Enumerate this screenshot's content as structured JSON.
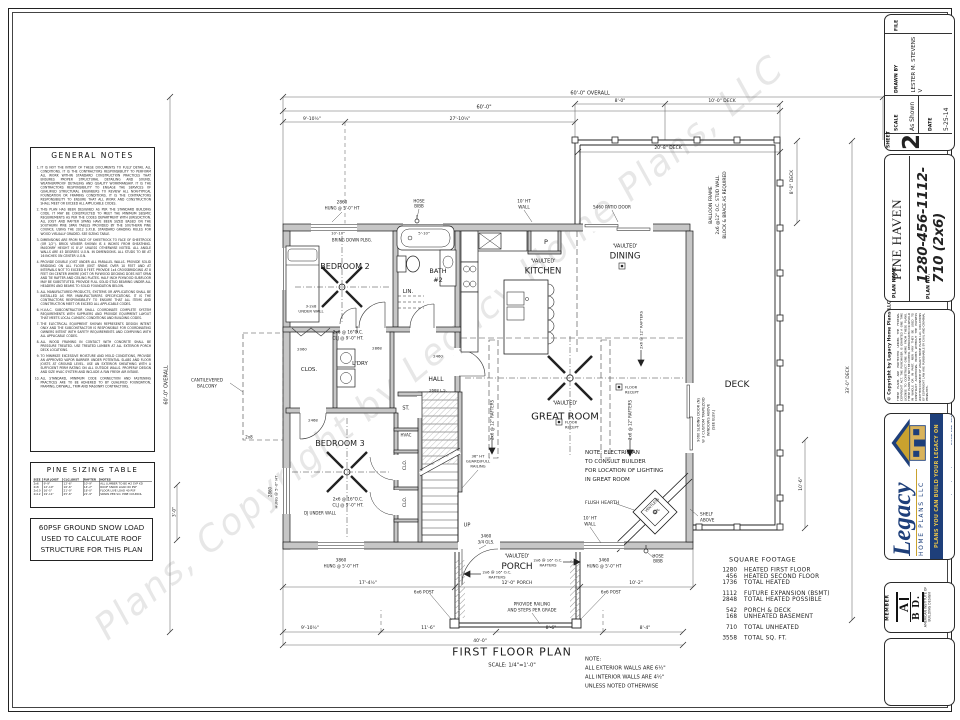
{
  "sheet": {
    "watermark": "Plans, Copyright by Legacy Home Plans, LLC",
    "general_notes": {
      "title": "GENERAL NOTES",
      "notes": [
        "IT IS NOT THE INTENT OF THESE DOCUMENTS TO FULLY DETAIL ALL CONDITIONS. IT IS THE CONTRACTORS RESPONSIBILITY TO PERFORM ALL WORK WITHIN STANDARD CONSTRUCTION PRACTICES THAT ENSURES PROPER STRUCTURAL DETAILING AND SOUND, WEATHERPROOF DETAILING AND QUALITY WORKMANSHIP. IT IS THE CONTRACTORS RESPONSIBILITY TO ENGAGE THE SERVICES OF QUALIFIED STRUCTURAL ENGINEERS TO REVIEW ALL NON-TYPICAL FOUNDATION OR FRAMING CONDITIONS. IT IS THE CONTRACTORS RESPONSIBILITY TO ENSURE THAT ALL WORK AND CONSTRUCTION SHALL MEET OR EXCEED ALL APPLICABLE CODES.",
        "THIS PLAN HAS BEEN DESIGNED AS PER THE STANDARD BUILDING CODE. IT MAY BE CONSTRUCTED TO MEET THE MINIMUM SEISMIC REQUIREMENTS AS PER THE CODES DEPARTMENT WITH JURISDICTION. ALL JOIST AND RAFTER SPANS HAVE BEEN SIZED BASED ON THE SOUTHERN PINE SPAN TABLES PROVIDED BY THE SOUTHERN PINE COUNCIL USING THE 2012 S.P.I.B. STANDARD GRADING RULES FOR WOOD VISUALLY GRADED. SEE SIZING TABLE.",
        "DIMENSIONS ARE FROM FACE OF SHEETROCK TO FACE OF SHEETROCK (OR 1/2\"). BRICK VENEER SHOWN IS 4 INCHES FROM SHEATHING. MASONRY HEIGHT IS 8'-0\" UNLESS OTHERWISE NOTED. ALL ANGLE WALLS ARE 45 DEGREES U.O.N. IN DIMENSIONS. ALL STUDS TO BE AT 16 INCHES ON CENTER U.O.N.",
        "PROVIDE DOUBLE JOIST UNDER ALL PARALLEL WALLS. PROVIDE SOLID BRIDGING ON ALL FLOOR JOIST SPANS OVER 10 FEET AND AT INTERVALS NOT TO EXCEED 8 FEET. PROVIDE 1x4 CROSSBRIDGING AT 8 FEET ON CENTER WHERE JOIST OR PLYWOOD DECKING DOES NOT SPAN AND TIE RAFTER AND CEILING PLATES. HALF INCH PLYWOOD SUBFLOOR MAY BE SUBSTITUTED. PROVIDE FULL SOLID STUD BEARING UNDER ALL HEADERS AND BEAMS TO SOLID FOUNDATION BELOW.",
        "ALL MANUFACTURED PRODUCTS, SYSTEMS OR APPLICATIONS SHALL BE INSTALLED AS PER MANUFACTURERS SPECIFICATIONS. IT IS THE CONTRACTORS RESPONSIBILITY TO ENSURE THAT ALL ITEMS AND CONSTRUCTION MEET OR EXCEED ALL APPLICABLE CODES.",
        "H.V.A.C. SUBCONTRACTOR SHALL COORDINATE COMPLETE SYSTEM REQUIREMENTS WITH SUPPLIERS AND PROVIDE EQUIPMENT LAYOUT THAT MEETS LOCAL CLIMATIC CONDITIONS AND BUILDING CODES.",
        "THE ELECTRICAL EQUIPMENT SHOWN REPRESENTS DESIGN INTENT ONLY AND THE SUBCONTRACTOR IS RESPONSIBLE FOR COORDINATING OWNERS INTENT WITH SAFETY REQUIREMENTS AND COMPLYING WITH ALL APPLICABLE CODES.",
        "ALL WOOD FRAMING IN CONTACT WITH CONCRETE SHALL BE PRESSURE TREATED. USE TREATED LUMBER AT ALL EXTERIOR PORCH DECK LOCATIONS.",
        "TO MINIMIZE EXCESSIVE MOISTURE AND MOLD CONDITIONS, PROVIDE AN APPROVED VAPOR BARRIER UNDER POTENTIAL SLABS AND FLOOR JOISTS AT GROUND LEVEL. USE AN EXTERIOR SHEATHING WITH A SUFFICIENT PERM RATING ON ALL OUTSIDE WALLS. PROPERLY DESIGN AND SIZE HVAC SYSTEM AND INCLUDE A FAN FRESH AIR INTAKE.",
        "ALL STANDARD, MINIMUM CODE CONNECTION AND FASTENING PRACTICES ARE TO BE ADHERED TO BY QUALIFIED FOUNDATION, FRAMING, DRYWALL, TRIM AND MASONRY CONTRACTORS."
      ]
    },
    "pine_sizing_table": {
      "title": "PINE SIZING TABLE",
      "headers": [
        "SIZE",
        "FLR JOIST",
        "CLG JOIST",
        "RAFTER",
        "NOTES"
      ],
      "rows": [
        [
          "2x6",
          "9'-9\"",
          "12'-6\"",
          "10'-9\"",
          "ALL LUMBER TO BE #2 SYP KD"
        ],
        [
          "2x8",
          "12'-10\"",
          "16'-6\"",
          "14'-2\"",
          "ROOF SNOW LOAD 60 PSF"
        ],
        [
          "2x10",
          "16'-5\"",
          "21'-0\"",
          "18'-0\"",
          "FLOOR LIVE LOAD 40 PSF"
        ],
        [
          "2x12",
          "19'-11\"",
          "25'-6\"",
          "21'-9\"",
          "SPANS PER SO. PINE COUNCIL"
        ]
      ]
    },
    "snow_load_note": "60PSF GROUND SNOW LOAD USED TO CALCULATE ROOF STRUCTURE FOR THIS PLAN"
  },
  "titleblock": {
    "file_label": "FILE",
    "sheet_label": "SHEET",
    "sheet_number": "2",
    "scale_label": "SCALE",
    "scale_value": "As Shown",
    "date_label": "DATE",
    "date_value": "5-25-14",
    "drawn_by_label": "DRAWN BY",
    "drawn_by_value": "LESTER M. STEVENS V",
    "plan_name_label": "PLAN NAME",
    "plan_name": "PINE HAVEN",
    "plan_no_label": "PLAN NO.",
    "plan_no": "1280-456-1112-710 (2x6)",
    "copyright_title": "© Copyright by Legacy Home Plans LLC",
    "copyright_body": "THESE PLANS ARE PROTECTED UNDER THE FEDERAL COPYRIGHT ACT. THE PURCHASER IS GRANTED A ONE TIME LICENSE TO CONSTRUCT ONE HOME FROM THESE PLANS. THESE PLANS MAY NOT BE COPIED, REPRODUCED OR RESOLD IN WHOLE OR IN PART, NOR MAY THEY BE USED TO CONSTRUCT ADDITIONAL HOMES WITHOUT THE EXPRESS WRITTEN CONSENT OF LEGACY HOME PLANS LLC. VIOLATIONS OF COPYRIGHT LAW ARE PUNISHABLE BY CIVIL AND CRIMINAL PENALTIES.",
    "logo": {
      "brand": "Legacy",
      "brand_sub": "HOME PLANS LLC",
      "tagline": "PLANS YOU CAN BUILD YOUR LEGACY ON",
      "contact": "www.legacyhomeplans.com  •  BARTLETT, TENNESSEE"
    },
    "member": {
      "label": "MEMBER",
      "letters_top": "A",
      "letters_bottom": "B D.",
      "caption": "AMERICAN INSTITUTE OF BUILDING DESIGN"
    }
  },
  "plan": {
    "square_footage": {
      "title": "SQUARE FOOTAGE",
      "rows": [
        {
          "v": "1280",
          "l": "HEATED FIRST FLOOR"
        },
        {
          "v": "456",
          "l": "HEATED SECOND FLOOR"
        },
        {
          "v": "1736",
          "l": "TOTAL HEATED"
        },
        {
          "v": "1112",
          "l": "FUTURE EXPANSION (BSMT)",
          "g": true
        },
        {
          "v": "2848",
          "l": "TOTAL HEATED POSSIBLE"
        },
        {
          "v": "542",
          "l": "PORCH & DECK",
          "g": true
        },
        {
          "v": "168",
          "l": "UNHEATED BASEMENT"
        },
        {
          "v": "710",
          "l": "TOTAL UNHEATED",
          "g": true
        },
        {
          "v": "3558",
          "l": "TOTAL SQ. FT.",
          "g": true
        }
      ]
    },
    "annotations": [
      {
        "t": "FIRST FLOOR PLAN",
        "x": 512,
        "y": 652,
        "s": 11,
        "n": "plan-title",
        "ls": 2
      },
      {
        "t": "SCALE: 1/4\"=1'-0\"",
        "x": 512,
        "y": 665,
        "s": 5.2,
        "n": "plan-scale"
      },
      {
        "t": "60'-0\" OVERALL",
        "x": 590,
        "y": 93,
        "s": 5
      },
      {
        "t": "8'-0\"",
        "x": 620,
        "y": 101,
        "s": 4.5
      },
      {
        "t": "10'-0\" DECK",
        "x": 722,
        "y": 101,
        "s": 4.5
      },
      {
        "t": "60'-0\"",
        "x": 484,
        "y": 107,
        "s": 5
      },
      {
        "t": "9'-10½\"",
        "x": 312,
        "y": 119,
        "s": 4.5
      },
      {
        "t": "27'-10½\"",
        "x": 460,
        "y": 119,
        "s": 4.5
      },
      {
        "t": "20'-8\" DECK",
        "x": 668,
        "y": 148,
        "s": 4.5
      },
      {
        "t": "8'-0\" DECK",
        "x": 792,
        "y": 182,
        "s": 4.5,
        "r": -90
      },
      {
        "t": "33'-0\" DECK",
        "x": 848,
        "y": 380,
        "s": 4.5,
        "r": -90
      },
      {
        "t": "10'-6\"",
        "x": 801,
        "y": 484,
        "s": 4.5,
        "r": -90
      },
      {
        "t": "60'-0\" OVERALL",
        "x": 166,
        "y": 385,
        "s": 5,
        "r": -90
      },
      {
        "t": "3'-0\"",
        "x": 174,
        "y": 512,
        "s": 4.2,
        "r": -90
      },
      {
        "t": "17'-4½\"",
        "x": 368,
        "y": 583,
        "s": 4.5
      },
      {
        "t": "12'-0\" PORCH",
        "x": 517,
        "y": 583,
        "s": 4.5
      },
      {
        "t": "10'-2\"",
        "x": 636,
        "y": 583,
        "s": 4.5
      },
      {
        "t": "9'-10½\"",
        "x": 310,
        "y": 628,
        "s": 4.5
      },
      {
        "t": "11'-6\"",
        "x": 428,
        "y": 628,
        "s": 4.5
      },
      {
        "t": "8'-6\"",
        "x": 551,
        "y": 628,
        "s": 4.5
      },
      {
        "t": "8'-4\"",
        "x": 645,
        "y": 628,
        "s": 4.5
      },
      {
        "t": "40'-0\"",
        "x": 480,
        "y": 641,
        "s": 4.5
      },
      {
        "t": "BEDROOM 2",
        "x": 345,
        "y": 266,
        "s": 8,
        "n": "room-label-bedroom-2"
      },
      {
        "t": "'VAULTED'",
        "x": 543,
        "y": 261,
        "s": 5
      },
      {
        "t": "KITCHEN",
        "x": 543,
        "y": 271,
        "s": 8.5,
        "n": "room-label-kitchen"
      },
      {
        "t": "'VAULTED'",
        "x": 625,
        "y": 246,
        "s": 5
      },
      {
        "t": "DINING",
        "x": 625,
        "y": 256,
        "s": 8.5,
        "n": "room-label-dining"
      },
      {
        "t": "'VAULTED'",
        "x": 565,
        "y": 403,
        "s": 5
      },
      {
        "t": "GREAT ROOM",
        "x": 565,
        "y": 416,
        "s": 10,
        "n": "room-label-great-room"
      },
      {
        "t": "DECK",
        "x": 737,
        "y": 384,
        "s": 9,
        "n": "room-label-deck"
      },
      {
        "t": "'VAULTED'",
        "x": 517,
        "y": 556,
        "s": 5
      },
      {
        "t": "PORCH",
        "x": 517,
        "y": 566,
        "s": 9,
        "n": "room-label-porch"
      },
      {
        "t": "BEDROOM 3",
        "x": 340,
        "y": 443,
        "s": 8,
        "n": "room-label-bedroom-3"
      },
      {
        "t": "BATH",
        "x": 438,
        "y": 271,
        "s": 6.5,
        "n": "room-label-bath-2"
      },
      {
        "t": "#2",
        "x": 438,
        "y": 280,
        "s": 6.5
      },
      {
        "t": "LIN.",
        "x": 408,
        "y": 291,
        "s": 5.5
      },
      {
        "t": "CLOS.",
        "x": 309,
        "y": 369,
        "s": 5.5
      },
      {
        "t": "L'DRY",
        "x": 360,
        "y": 363,
        "s": 5.5
      },
      {
        "t": "HALL",
        "x": 436,
        "y": 379,
        "s": 6
      },
      {
        "t": "ST.",
        "x": 406,
        "y": 408,
        "s": 5
      },
      {
        "t": "HVAC",
        "x": 406,
        "y": 435,
        "s": 4
      },
      {
        "t": "CLO.",
        "x": 405,
        "y": 465,
        "s": 4.5,
        "r": -90
      },
      {
        "t": "CLO.",
        "x": 405,
        "y": 502,
        "s": 4.5,
        "r": -90
      },
      {
        "t": "P",
        "x": 546,
        "y": 242,
        "s": 6.5
      },
      {
        "t": "2860",
        "x": 342,
        "y": 202,
        "s": 4.2
      },
      {
        "t": "HUNG @ 5'-0\" HT",
        "x": 342,
        "y": 208,
        "s": 4
      },
      {
        "t": "HOSE",
        "x": 419,
        "y": 201,
        "s": 4
      },
      {
        "t": "BIBB",
        "x": 419,
        "y": 206,
        "s": 4
      },
      {
        "t": "10' HT",
        "x": 524,
        "y": 201,
        "s": 4.2
      },
      {
        "t": "WALL",
        "x": 524,
        "y": 207,
        "s": 4.2
      },
      {
        "t": "5460 PATIO DOOR",
        "x": 612,
        "y": 207,
        "s": 4.2
      },
      {
        "t": "3860",
        "x": 341,
        "y": 560,
        "s": 4.2
      },
      {
        "t": "HUNG @ 5'-0\" HT",
        "x": 341,
        "y": 566,
        "s": 4
      },
      {
        "t": "3460",
        "x": 604,
        "y": 560,
        "s": 4.2
      },
      {
        "t": "HUNG @ 5'-0\" HT",
        "x": 604,
        "y": 566,
        "s": 4
      },
      {
        "t": "2860",
        "x": 270,
        "y": 492,
        "s": 4,
        "r": -90
      },
      {
        "t": "HUNG @ 5'-0\" HT",
        "x": 276,
        "y": 492,
        "s": 3.8,
        "r": -90
      },
      {
        "t": "2060",
        "x": 302,
        "y": 349,
        "s": 3.8
      },
      {
        "t": "2868",
        "x": 377,
        "y": 348,
        "s": 3.8
      },
      {
        "t": "2460",
        "x": 438,
        "y": 356,
        "s": 3.8
      },
      {
        "t": "2668 L.S.",
        "x": 438,
        "y": 390,
        "s": 3.8
      },
      {
        "t": "2468",
        "x": 313,
        "y": 420,
        "s": 3.8
      },
      {
        "t": "3460",
        "x": 486,
        "y": 536,
        "s": 4.2
      },
      {
        "t": "3/4 GLS.",
        "x": 486,
        "y": 542,
        "s": 4
      },
      {
        "t": "BRING DOWN PLBG.",
        "x": 352,
        "y": 240,
        "s": 4
      },
      {
        "t": "10'-10\"",
        "x": 338,
        "y": 233,
        "s": 3.8
      },
      {
        "t": "5'-10\"",
        "x": 424,
        "y": 233,
        "s": 3.8
      },
      {
        "t": "2x6 @ 16\"O.C.",
        "x": 348,
        "y": 332,
        "s": 4.2
      },
      {
        "t": "CLJ @ 9'-0\" HT.",
        "x": 348,
        "y": 338,
        "s": 4.2
      },
      {
        "t": "2x6 @ 16\"O.C.",
        "x": 348,
        "y": 499,
        "s": 4.2
      },
      {
        "t": "CLJ @ 9'-0\" HT.",
        "x": 348,
        "y": 505,
        "s": 4.2
      },
      {
        "t": "3-2x8",
        "x": 311,
        "y": 306,
        "s": 3.8
      },
      {
        "t": "UNDER WALL",
        "x": 311,
        "y": 311,
        "s": 3.8
      },
      {
        "t": "DJ UNDER WALL",
        "x": 320,
        "y": 513,
        "s": 4
      },
      {
        "t": "CANTILEVERED",
        "x": 207,
        "y": 380,
        "s": 4.2
      },
      {
        "t": "BALCONY",
        "x": 207,
        "y": 386,
        "s": 4.2
      },
      {
        "t": "2x8",
        "x": 249,
        "y": 437,
        "s": 4
      },
      {
        "t": "NOTE: ELECTRICIAN",
        "x": 585,
        "y": 452,
        "s": 5.5,
        "al": "l",
        "n": "electrician-note"
      },
      {
        "t": "TO CONSULT BUILDER",
        "x": 585,
        "y": 461,
        "s": 5.5,
        "al": "l"
      },
      {
        "t": "FOR LOCATION OF LIGHTING",
        "x": 585,
        "y": 470,
        "s": 5.5,
        "al": "l"
      },
      {
        "t": "IN GREAT ROOM",
        "x": 585,
        "y": 479,
        "s": 5.5,
        "al": "l"
      },
      {
        "t": "FLUSH HEARTH",
        "x": 585,
        "y": 503,
        "s": 4.5,
        "al": "l"
      },
      {
        "t": "VENTLESS",
        "x": 652,
        "y": 505,
        "s": 3.6,
        "r": -45
      },
      {
        "t": "FPL",
        "x": 657,
        "y": 511,
        "s": 3.6,
        "r": -45
      },
      {
        "t": "SHELF",
        "x": 700,
        "y": 514,
        "s": 4.2,
        "al": "l"
      },
      {
        "t": "ABOVE",
        "x": 700,
        "y": 520,
        "s": 4.2,
        "al": "l"
      },
      {
        "t": "36\" HT",
        "x": 478,
        "y": 456,
        "s": 3.8
      },
      {
        "t": "GUARD/FULL",
        "x": 478,
        "y": 461,
        "s": 3.8
      },
      {
        "t": "RAILING",
        "x": 478,
        "y": 466,
        "s": 3.8
      },
      {
        "t": "UP",
        "x": 467,
        "y": 525,
        "s": 5
      },
      {
        "t": "10' HT",
        "x": 590,
        "y": 518,
        "s": 4.2
      },
      {
        "t": "WALL",
        "x": 590,
        "y": 524,
        "s": 4.2
      },
      {
        "t": "FLOOR",
        "x": 565,
        "y": 422,
        "s": 3.6,
        "al": "l"
      },
      {
        "t": "RECEPT",
        "x": 565,
        "y": 427,
        "s": 3.6,
        "al": "l"
      },
      {
        "t": "FLOOR",
        "x": 625,
        "y": 387,
        "s": 3.6,
        "al": "l"
      },
      {
        "t": "RECEPT",
        "x": 625,
        "y": 392,
        "s": 3.6,
        "al": "l"
      },
      {
        "t": "2x6 @ 12\" RAFTERS",
        "x": 492,
        "y": 420,
        "s": 4,
        "r": -90
      },
      {
        "t": "2x6 @ 12\" RAFTERS",
        "x": 630,
        "y": 420,
        "s": 4,
        "r": -90
      },
      {
        "t": "2x6 @ 12\" RAFTERS",
        "x": 641,
        "y": 330,
        "s": 3.8,
        "r": -90
      },
      {
        "t": "BALLOON FRAME",
        "x": 711,
        "y": 205,
        "s": 4.4,
        "r": -90
      },
      {
        "t": "2x6 @12\" O.C. STUD WALL",
        "x": 718,
        "y": 205,
        "s": 4.4,
        "r": -90
      },
      {
        "t": "BLOCK & BRACE AS REQUIRED",
        "x": 725,
        "y": 205,
        "s": 4.4,
        "r": -90
      },
      {
        "t": "9060 SLIDING DOOR (N)",
        "x": 698,
        "y": 420,
        "s": 3.6,
        "r": -90
      },
      {
        "t": "W 3 CUSTOM TRAPEZOID",
        "x": 703,
        "y": 420,
        "s": 3.6,
        "r": -90
      },
      {
        "t": "WINDOWS ABOVE",
        "x": 708,
        "y": 420,
        "s": 3.6,
        "r": -90
      },
      {
        "t": "(SEE ELEV.)",
        "x": 713,
        "y": 420,
        "s": 3.6,
        "r": -90
      },
      {
        "t": "HOSE",
        "x": 658,
        "y": 556,
        "s": 4
      },
      {
        "t": "BIBB",
        "x": 658,
        "y": 561,
        "s": 4
      },
      {
        "t": "2x6 @ 16\" O.C.",
        "x": 548,
        "y": 560,
        "s": 3.8
      },
      {
        "t": "RAFTERS",
        "x": 548,
        "y": 565,
        "s": 3.8
      },
      {
        "t": "2x6 @ 16\" O.C.",
        "x": 497,
        "y": 572,
        "s": 3.8
      },
      {
        "t": "RAFTERS",
        "x": 497,
        "y": 577,
        "s": 3.8
      },
      {
        "t": "6x6 POST",
        "x": 424,
        "y": 592,
        "s": 4.2
      },
      {
        "t": "6x6 POST",
        "x": 611,
        "y": 592,
        "s": 4.2
      },
      {
        "t": "PROVIDE RAILING",
        "x": 532,
        "y": 604,
        "s": 4.2
      },
      {
        "t": "AND STEPS PER GRADE",
        "x": 532,
        "y": 610,
        "s": 4.2
      },
      {
        "t": "NOTE:",
        "x": 585,
        "y": 659,
        "s": 5.2,
        "al": "l",
        "n": "wall-note"
      },
      {
        "t": "ALL EXTERIOR WALLS ARE 6½\"",
        "x": 585,
        "y": 668,
        "s": 5.2,
        "al": "l"
      },
      {
        "t": "ALL INTERIOR WALLS ARE 4½\"",
        "x": 585,
        "y": 677,
        "s": 5.2,
        "al": "l"
      },
      {
        "t": "UNLESS NOTED OTHERWISE",
        "x": 585,
        "y": 686,
        "s": 5.2,
        "al": "l"
      }
    ]
  },
  "colors": {
    "navy": "#1e3f7a",
    "gold": "#c9a22e",
    "wall_gray": "#c6c6c6"
  }
}
